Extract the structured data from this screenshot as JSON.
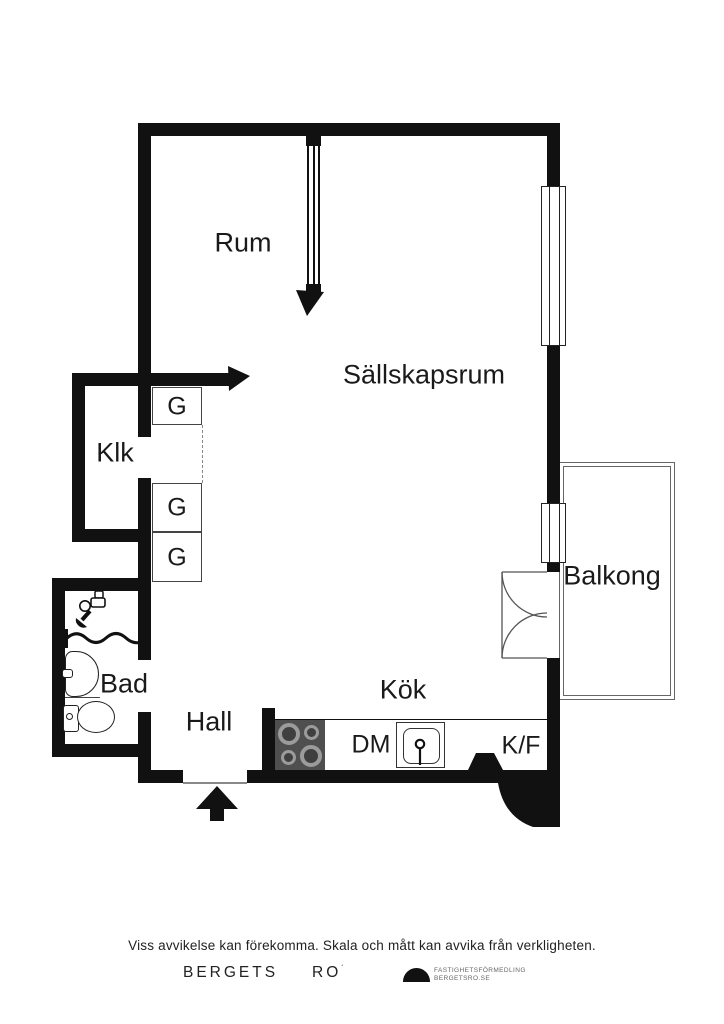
{
  "floorplan": {
    "room_labels": {
      "rum": "Rum",
      "sallskapsrum": "Sällskapsrum",
      "klk": "Klk",
      "bad": "Bad",
      "hall": "Hall",
      "kok": "Kök",
      "balkong": "Balkong"
    },
    "fixture_labels": {
      "wardrobe": "G",
      "dishwasher": "DM",
      "fridge_freezer": "K/F"
    },
    "icons": {
      "entrance": "entrance-arrow-up-icon",
      "balcony_doors": "double-door-swing-icon",
      "sliding_partition": "partition-arrow-icon",
      "opening_arrow": "wall-opening-arrow-icon",
      "shower": "shower-mixer-icon",
      "shower_curtain": "shower-curtain-wave-icon",
      "bathroom_sink": "washbasin-icon",
      "toilet": "toilet-icon",
      "stove": "stove-four-burners-icon",
      "kitchen_sink": "kitchen-sink-icon"
    },
    "colors": {
      "wall": "#111111",
      "background": "#ffffff",
      "stove": "#4f4f4f",
      "burner_ring": "#9b9b9b",
      "thin_line": "#333333"
    }
  },
  "footer": {
    "disclaimer": "Viss avvikelse kan förekomma. Skala och mått kan avvika från verkligheten.",
    "brand_primary": "BERGETS",
    "brand_secondary": "RO",
    "brand_mark": "´",
    "agency_line1": "FASTIGHETSFÖRMEDLING",
    "agency_line2": "BERGETSRO.SE"
  }
}
